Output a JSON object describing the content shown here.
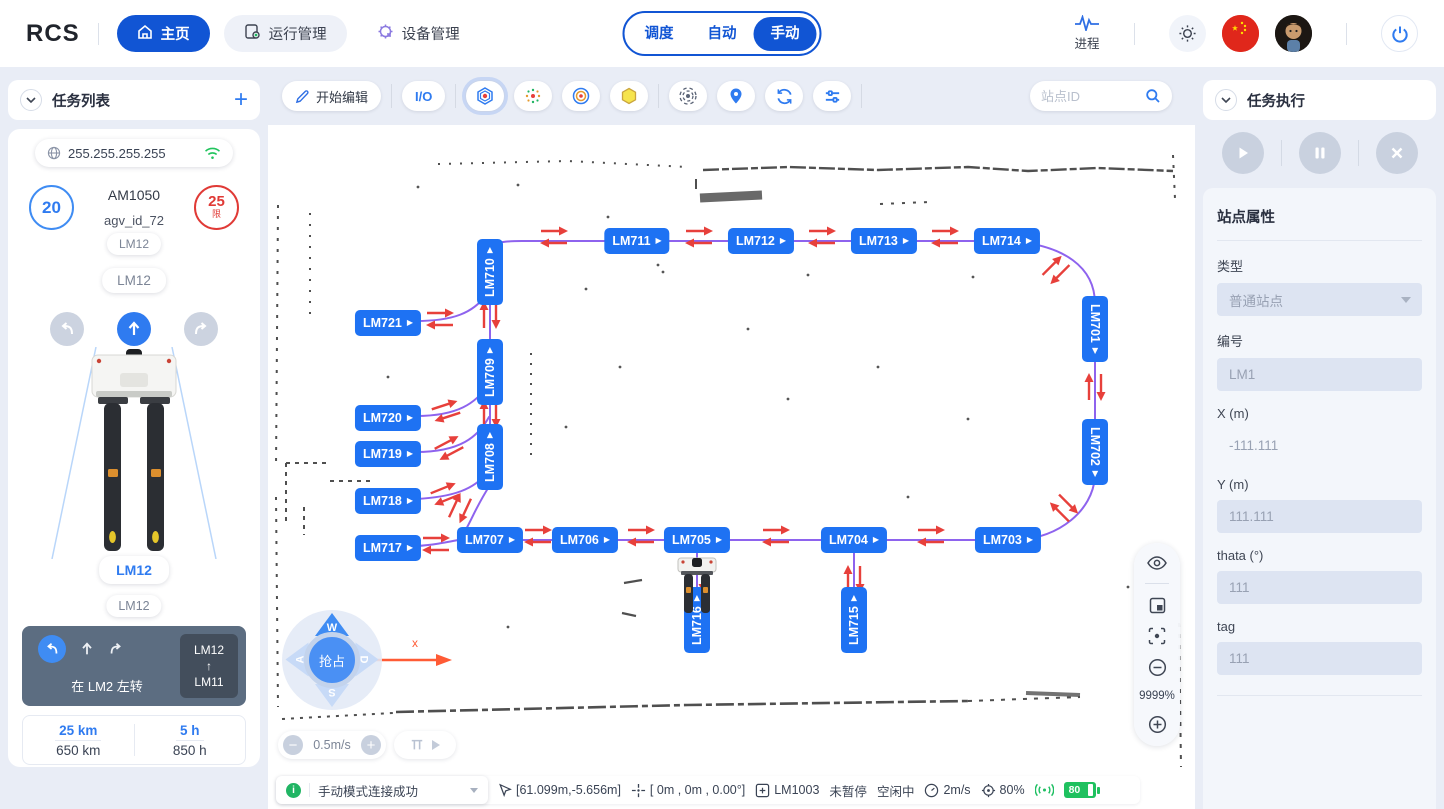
{
  "topbar": {
    "logo": "RCS",
    "nav": [
      {
        "label": "主页"
      },
      {
        "label": "运行管理"
      },
      {
        "label": "设备管理"
      }
    ],
    "modes": [
      "调度",
      "自动",
      "手动"
    ],
    "active_mode": "手动",
    "process_label": "进程"
  },
  "left": {
    "title": "任务列表",
    "ip": "255.255.255.255",
    "speed_value": "20",
    "limit_value": "25",
    "limit_char": "限",
    "model": "AM1050",
    "agv_id": "agv_id_72",
    "pill_top": "LM12",
    "pill_mid": "LM12",
    "pill_front": "LM12",
    "pill_front2": "LM12",
    "hint": "在 LM2 左转",
    "route": {
      "from": "LM12",
      "arrow": "↑",
      "to": "LM11"
    },
    "stats": [
      {
        "value": "25 km",
        "total": "650 km"
      },
      {
        "value": "5 h",
        "total": "850 h"
      }
    ]
  },
  "map": {
    "edit_label": "开始编辑",
    "io_label": "I/O",
    "search_placeholder": "站点ID",
    "zoom_level": "9999%",
    "speed": "0.5m/s",
    "joystick": {
      "w": "W",
      "a": "A",
      "s": "S",
      "d": "D",
      "center": "抢占",
      "axis": "x"
    },
    "station_arrow": "▶",
    "stations": [
      {
        "id": "LM711",
        "x": 369,
        "y": 174,
        "o": "h"
      },
      {
        "id": "LM712",
        "x": 493,
        "y": 174,
        "o": "h"
      },
      {
        "id": "LM713",
        "x": 616,
        "y": 174,
        "o": "h"
      },
      {
        "id": "LM714",
        "x": 739,
        "y": 174,
        "o": "h"
      },
      {
        "id": "LM710",
        "x": 222,
        "y": 205,
        "o": "vup"
      },
      {
        "id": "LM721",
        "x": 120,
        "y": 256,
        "o": "h"
      },
      {
        "id": "LM709",
        "x": 222,
        "y": 305,
        "o": "vup"
      },
      {
        "id": "LM720",
        "x": 120,
        "y": 351,
        "o": "h"
      },
      {
        "id": "LM719",
        "x": 120,
        "y": 387,
        "o": "h"
      },
      {
        "id": "LM708",
        "x": 222,
        "y": 390,
        "o": "vup"
      },
      {
        "id": "LM718",
        "x": 120,
        "y": 434,
        "o": "h"
      },
      {
        "id": "LM717",
        "x": 120,
        "y": 481,
        "o": "h"
      },
      {
        "id": "LM707",
        "x": 222,
        "y": 473,
        "o": "h"
      },
      {
        "id": "LM706",
        "x": 317,
        "y": 473,
        "o": "h"
      },
      {
        "id": "LM705",
        "x": 429,
        "y": 473,
        "o": "h"
      },
      {
        "id": "LM704",
        "x": 586,
        "y": 473,
        "o": "h"
      },
      {
        "id": "LM703",
        "x": 740,
        "y": 473,
        "o": "h"
      },
      {
        "id": "LM701",
        "x": 827,
        "y": 262,
        "o": "vdown"
      },
      {
        "id": "LM702",
        "x": 827,
        "y": 385,
        "o": "vdown"
      },
      {
        "id": "LM716",
        "x": 429,
        "y": 553,
        "o": "vup"
      },
      {
        "id": "LM715",
        "x": 586,
        "y": 553,
        "o": "vup"
      }
    ],
    "arrows": [
      {
        "x": 286,
        "y": 170,
        "t": "h"
      },
      {
        "x": 431,
        "y": 170,
        "t": "h"
      },
      {
        "x": 554,
        "y": 170,
        "t": "h"
      },
      {
        "x": 677,
        "y": 170,
        "t": "h"
      },
      {
        "x": 270,
        "y": 469,
        "t": "h"
      },
      {
        "x": 373,
        "y": 469,
        "t": "h"
      },
      {
        "x": 508,
        "y": 469,
        "t": "h"
      },
      {
        "x": 663,
        "y": 469,
        "t": "h"
      },
      {
        "x": 172,
        "y": 252,
        "t": "h"
      },
      {
        "x": 168,
        "y": 477,
        "t": "h"
      },
      {
        "x": 178,
        "y": 344,
        "t": "h",
        "r": -18
      },
      {
        "x": 181,
        "y": 381,
        "t": "h",
        "r": -28
      },
      {
        "x": 177,
        "y": 427,
        "t": "h",
        "r": -22
      },
      {
        "x": 788,
        "y": 203,
        "t": "h",
        "r": -45
      },
      {
        "x": 796,
        "y": 441,
        "t": "h",
        "r": 45
      },
      {
        "x": 222,
        "y": 248,
        "t": "v"
      },
      {
        "x": 222,
        "y": 347,
        "t": "v"
      },
      {
        "x": 827,
        "y": 320,
        "t": "v"
      },
      {
        "x": 429,
        "y": 512,
        "t": "v"
      },
      {
        "x": 586,
        "y": 512,
        "t": "v"
      },
      {
        "x": 192,
        "y": 441,
        "t": "v",
        "r": 25
      }
    ]
  },
  "right": {
    "title": "任务执行",
    "panel_title": "站点属性",
    "fields": [
      {
        "label": "类型",
        "value": "普通站点",
        "kind": "select"
      },
      {
        "label": "编号",
        "value": "LM1",
        "kind": "input"
      },
      {
        "label": "X (m)",
        "value": "-111.111",
        "kind": "plain"
      },
      {
        "label": "Y (m)",
        "value": "111.111",
        "kind": "input"
      },
      {
        "label": "thata (°)",
        "value": "111",
        "kind": "input"
      },
      {
        "label": "tag",
        "value": "111",
        "kind": "input"
      }
    ]
  },
  "statusbar": {
    "mode_text": "手动模式连接成功",
    "pointer": "[61.099m,-5.656m]",
    "pose": "[ 0m , 0m , 0.00°]",
    "station": "LM1003",
    "pause": "未暂停",
    "idle": "空闲中",
    "speed": "2m/s",
    "percent": "80%",
    "battery": "80"
  }
}
